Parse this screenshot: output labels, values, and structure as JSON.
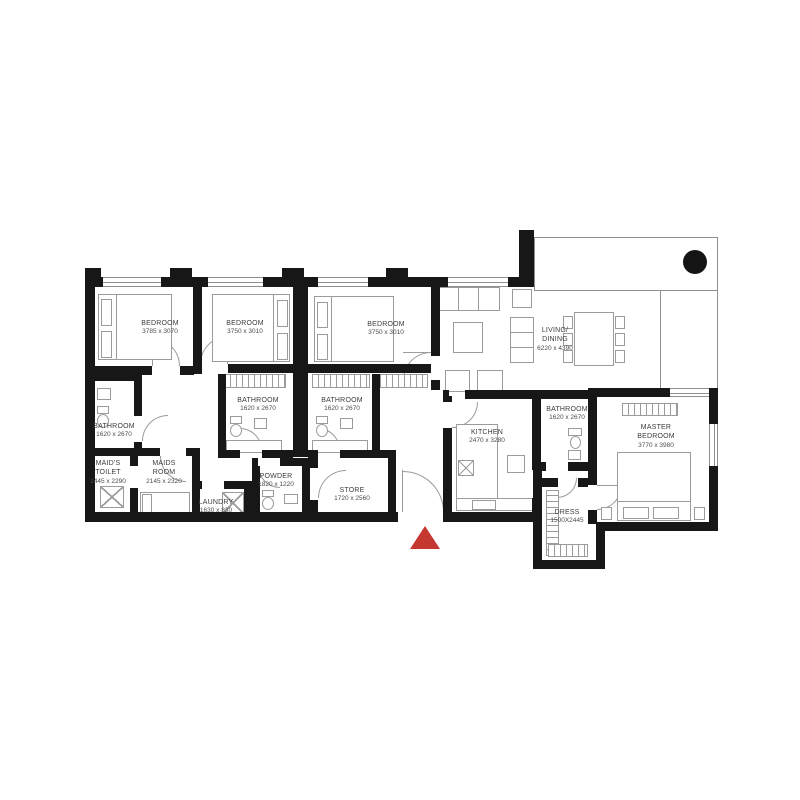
{
  "plan_type": "apartment-floor-plan",
  "colors": {
    "wall": "#171717",
    "furniture_line": "#9b9b9b",
    "entrance_marker": "#c5382f"
  },
  "markers": {
    "entrance": "entrance-arrow",
    "column": "structural-column"
  },
  "rooms": {
    "bedroom1": {
      "name": "BEDROOM",
      "dims": "3785 x 3070"
    },
    "bedroom2": {
      "name": "BEDROOM",
      "dims": "3750 x 3010"
    },
    "bedroom3": {
      "name": "BEDROOM",
      "dims": "3750 x 3010"
    },
    "living_dining": {
      "name": "LIVING/\nDINING",
      "dims": "6220 x 4390"
    },
    "bathroom1": {
      "name": "BATHROOM",
      "dims": "1620 x 2670"
    },
    "bathroom2": {
      "name": "BATHROOM",
      "dims": "1620 x 2670"
    },
    "bathroom3": {
      "name": "BATHROOM",
      "dims": "1620 x 2670"
    },
    "bathroom_master": {
      "name": "BATHROOM",
      "dims": "1620 x 2670"
    },
    "maids_toilet": {
      "name": "MAID'S\nTOILET",
      "dims": "1445 x 2290"
    },
    "maids_room": {
      "name": "MAIDS\nROOM",
      "dims": "2145 x 2320"
    },
    "laundry": {
      "name": "LAUNDRY",
      "dims": "1630 x 830"
    },
    "powder": {
      "name": "POWDER",
      "dims": "1820 x 1220"
    },
    "store": {
      "name": "STORE",
      "dims": "1720 x 2560"
    },
    "kitchen": {
      "name": "KITCHEN",
      "dims": "2470 x 3280"
    },
    "master_bedroom": {
      "name": "MASTER\nBEDROOM",
      "dims": "3770 x 3980"
    },
    "dress": {
      "name": "DRESS",
      "dims": "1500X2445"
    }
  }
}
